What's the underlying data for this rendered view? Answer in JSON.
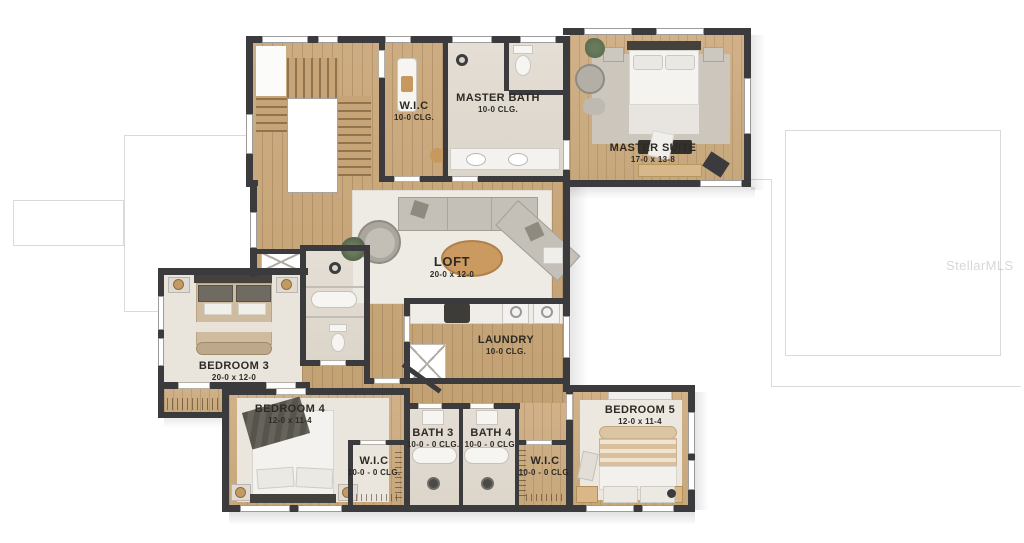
{
  "watermark": {
    "text": "StellarMLS"
  },
  "palette": {
    "wall": "#3b3b3d",
    "wood_floor": "#c9a87e",
    "tile_floor": "#e0dad1",
    "carpet": "#eae5dc",
    "rug_gray": "#cdc6bd",
    "rug_light": "#edebe4",
    "accent_wood": "#ca9a60",
    "label_text": "#2d2a25"
  },
  "rooms": {
    "master_wic": {
      "name": "W.I.C",
      "dims": "10-0 CLG."
    },
    "master_bath": {
      "name": "MASTER BATH",
      "dims": "10-0 CLG."
    },
    "master_suite": {
      "name": "MASTER SUITE",
      "dims": "17-0 x 13-8"
    },
    "loft": {
      "name": "LOFT",
      "dims": "20-0  x 12-0"
    },
    "laundry": {
      "name": "LAUNDRY",
      "dims": "10-0 CLG."
    },
    "bedroom3": {
      "name": "BEDROOM 3",
      "dims": "20-0  x 12-0"
    },
    "bedroom4": {
      "name": "BEDROOM 4",
      "dims": "12-0  x 11-4"
    },
    "bath3": {
      "name": "BATH 3",
      "dims": "10-0 - 0 CLG."
    },
    "bath4": {
      "name": "BATH 4",
      "dims": "10-0 - 0 CLG."
    },
    "wic_bed4": {
      "name": "W.I.C",
      "dims": "10-0 - 0 CLG."
    },
    "wic_bed5": {
      "name": "W.I.C",
      "dims": "10-0 - 0 CLG."
    },
    "bedroom5": {
      "name": "BEDROOM 5",
      "dims": "12-0  x 11-4"
    }
  }
}
